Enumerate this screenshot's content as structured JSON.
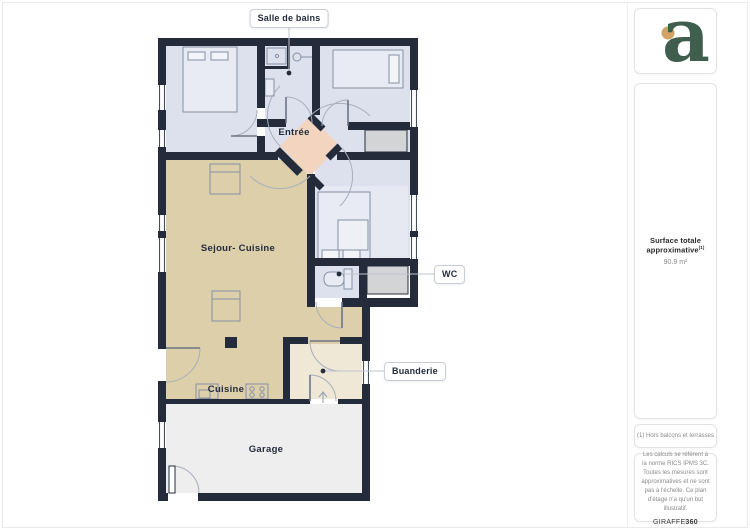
{
  "plan": {
    "room_labels": {
      "entree": "Entrée",
      "sejour_cuisine": "Sejour- Cuisine",
      "cuisine": "Cuisine",
      "garage": "Garage"
    },
    "callouts": {
      "salle_de_bains": "Salle de bains",
      "wc": "WC",
      "buanderie": "Buanderie"
    }
  },
  "sidebar": {
    "logo_letter": "a",
    "surface_title": "Surface totale approximative",
    "surface_footnote_marker": "(1)",
    "surface_value": "90.9 m²",
    "footnote": "(1) Hors balcons et terrasses",
    "disclaimer": "Les calculs se réfèrent à la norme RICS IPMS 3C. Toutes les mesures sont approximatives et ne sont pas à l'échelle. Ce plan d'étage n'a qu'un but illustratif.",
    "brand_name": "GIRAFFE",
    "brand_suffix": "360"
  },
  "colors": {
    "wall": "#242c3c",
    "bedroom_floor": "#dde1ed",
    "living_floor": "#dccfaa",
    "entry_floor": "#f3d4bf",
    "laundry_floor": "#efe8d6",
    "garage_floor": "#eeeeef",
    "closet_fill": "#d3d4d6",
    "logo_green": "#3f5e4e",
    "logo_dot": "#d2a266"
  }
}
